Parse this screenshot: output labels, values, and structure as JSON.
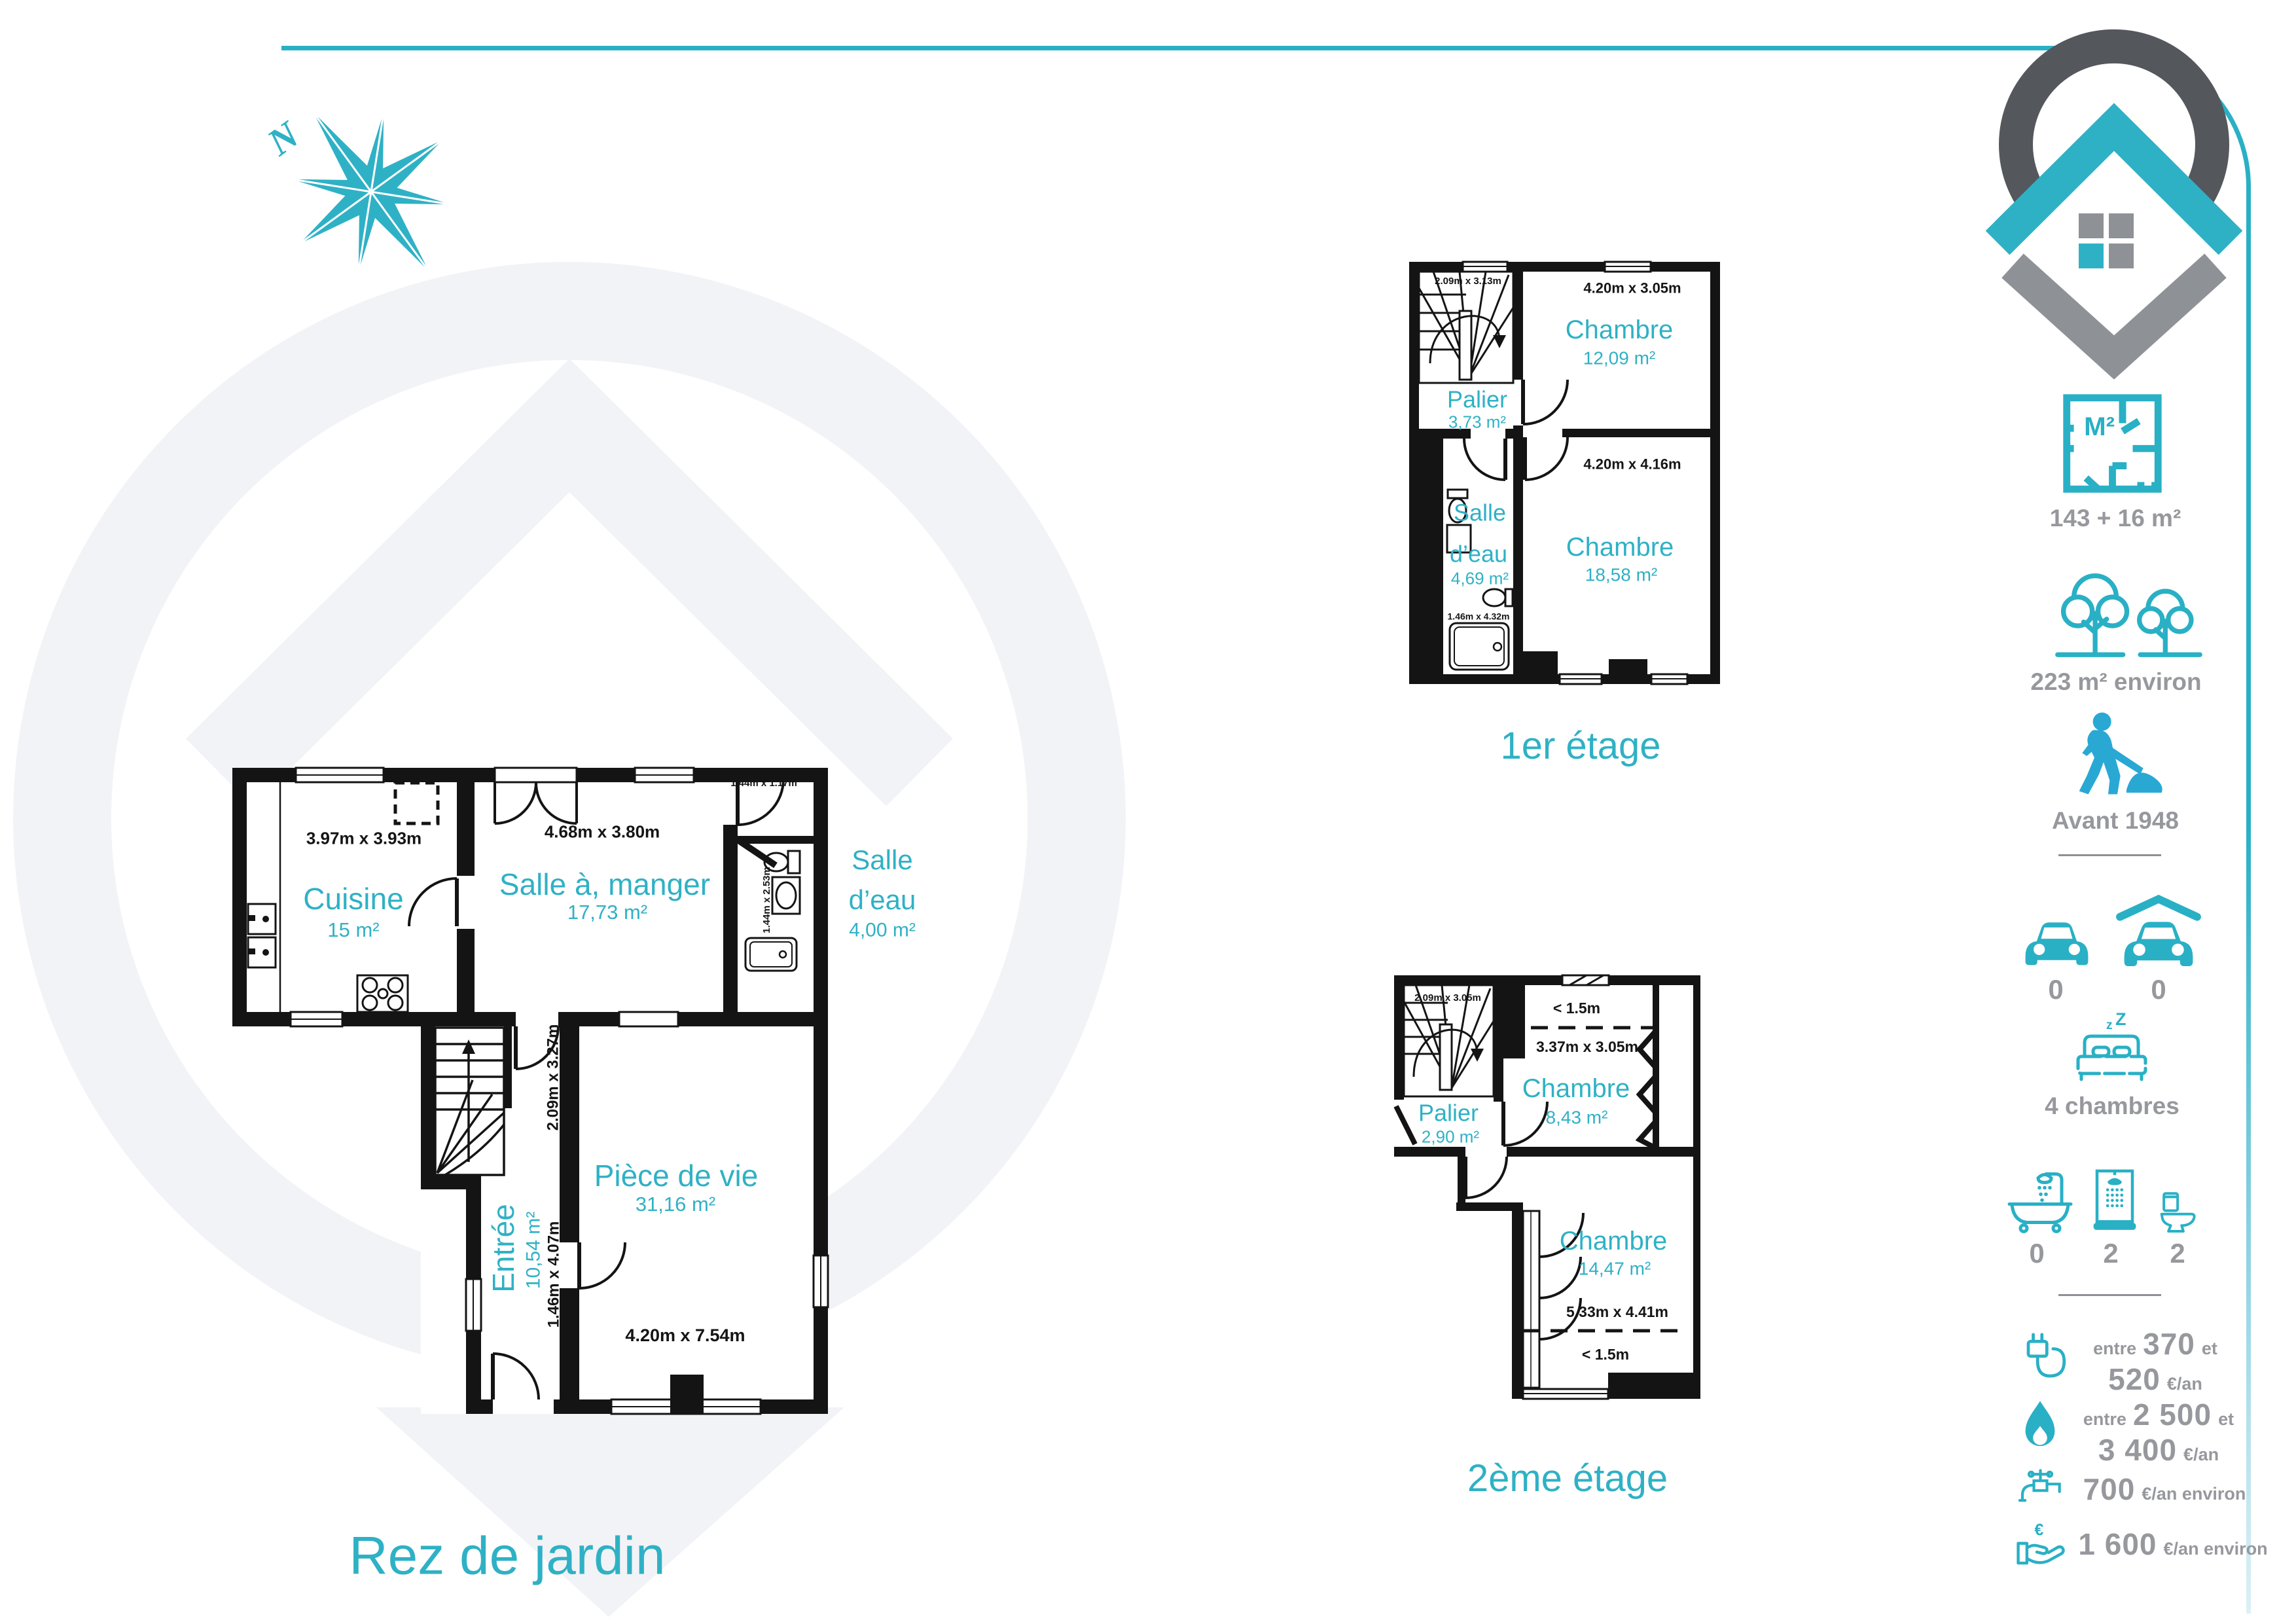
{
  "page": {
    "titles": {
      "rdj": "Rez de jardin",
      "e1": "1er étage",
      "e2": "2ème étage"
    },
    "compass_north": "N"
  },
  "rdj": {
    "cuisine": {
      "name": "Cuisine",
      "area": "15 m²",
      "dims": "3.97m x 3.93m"
    },
    "salle_a_manger": {
      "name": "Salle à, manger",
      "area": "17,73 m²",
      "dims": "4.68m x 3.80m"
    },
    "salle_eau": {
      "name": "Salle",
      "name2": "d’eau",
      "area": "4,00 m²",
      "dims_top": "1.44m x 1.17m",
      "dims_side": "1.44m x 2.53m"
    },
    "entree": {
      "name": "Entrée",
      "area": "10,54 m²",
      "dims_side": "1.46m x 4.07m",
      "dims_stair": "2.09m x 3.27m"
    },
    "piece_de_vie": {
      "name": "Pièce de vie",
      "area": "31,16 m²",
      "dims": "4.20m x 7.54m"
    }
  },
  "e1": {
    "palier": {
      "name": "Palier",
      "area": "3,73 m²",
      "dims": "2.09m x 3.13m"
    },
    "chambre1": {
      "name": "Chambre",
      "area": "12,09 m²",
      "dims": "4.20m x 3.05m"
    },
    "chambre2": {
      "name": "Chambre",
      "area": "18,58 m²",
      "dims": "4.20m x 4.16m"
    },
    "salle_eau": {
      "name": "Salle",
      "name2": "d’eau",
      "area": "4,69 m²",
      "dims": "1.46m x 4.32m"
    }
  },
  "e2": {
    "palier": {
      "name": "Palier",
      "area": "2,90 m²",
      "dims": "2.09m x 3.05m"
    },
    "chambre1": {
      "name": "Chambre",
      "area": "8,43 m²",
      "dims": "3.37m x 3.05m",
      "height": "< 1.5m"
    },
    "chambre2": {
      "name": "Chambre",
      "area": "14,47 m²",
      "dims": "5.33m x 4.41m",
      "height": "< 1.5m"
    }
  },
  "sidebar": {
    "m2_label": "M²",
    "surface": "143 + 16 m²",
    "land": "223 m² environ",
    "year": "Avant 1948",
    "parking": "0",
    "garage": "0",
    "bed_z1": "z",
    "bed_z2": "Z",
    "bedrooms": "4 chambres",
    "bathtubs": "0",
    "showers": "2",
    "wcs": "2",
    "euro_symbol": "€",
    "energy": {
      "elec_1a": "entre",
      "elec_1b": "370",
      "elec_1c": "et",
      "elec_2a": "520",
      "elec_2b": "€/an",
      "gas_1a": "entre",
      "gas_1b": "2 500",
      "gas_1c": "et",
      "gas_2a": "3 400",
      "gas_2b": "€/an",
      "water_a": "700",
      "water_b": "€/an environ",
      "fees_a": "1 600",
      "fees_b": "€/an environ"
    }
  },
  "colors": {
    "teal": "#2fb1c5",
    "gray_text": "#97989d",
    "wall": "#141414",
    "logo_dark": "#54575c",
    "logo_gray": "#8e9196",
    "watermark": "#f2f3f6"
  }
}
